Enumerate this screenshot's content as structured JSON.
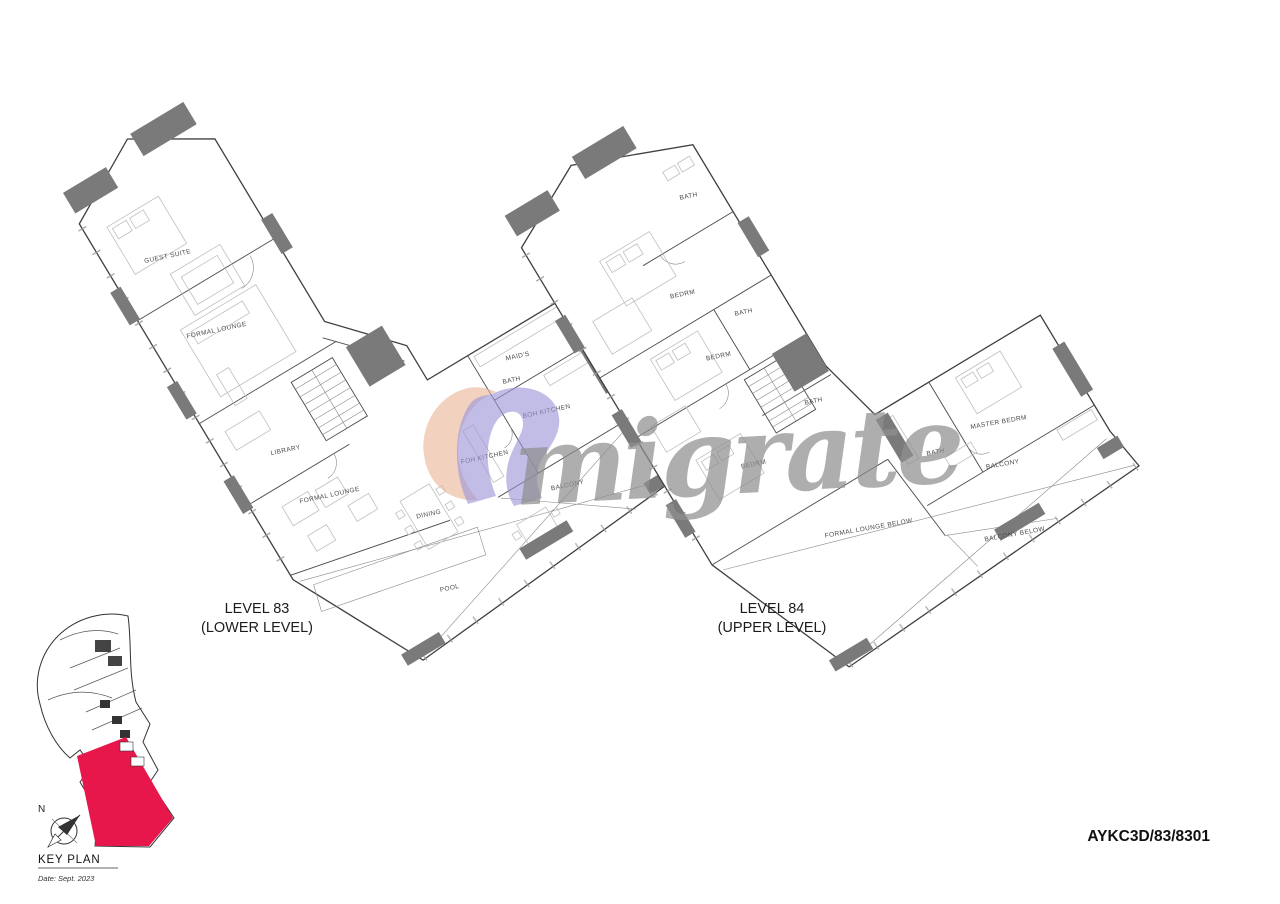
{
  "document": {
    "background": "#ffffff"
  },
  "plans": {
    "level83": {
      "title": "LEVEL 83",
      "subtitle": "(LOWER LEVEL)",
      "rooms": {
        "guest_suite": "GUEST SUITE",
        "formal_lounge_upper": "FORMAL LOUNGE",
        "library": "LIBRARY",
        "formal_lounge_lower": "FORMAL LOUNGE",
        "dining": "DINING",
        "pool": "POOL",
        "balcony": "BALCONY",
        "foh_kitchen": "FOH KITCHEN",
        "boh_kitchen": "BOH KITCHEN",
        "maids": "MAID'S",
        "bath": "BATH"
      }
    },
    "level84": {
      "title": "LEVEL 84",
      "subtitle": "(UPPER LEVEL)",
      "rooms": {
        "bath_top": "BATH",
        "bedroom_1": "BEDRM",
        "bath_mid": "BATH",
        "bedroom_2": "BEDRM",
        "bath_lower": "BATH",
        "bedroom_3": "BEDRM",
        "master_bedroom": "MASTER BEDRM",
        "master_bath": "BATH",
        "balcony": "BALCONY",
        "formal_lounge_below": "FORMAL LOUNGE BELOW",
        "balcony_below": "BALCONY BELOW"
      }
    }
  },
  "key_plan": {
    "title": "KEY PLAN",
    "date": "Date: Sept. 2023",
    "north_label": "N",
    "highlight_color": "#e8174b"
  },
  "title_block": {
    "drawing_number": "AYKC3D/83/8301"
  },
  "watermark": {
    "text": "migrate",
    "script_color": "#8f8f8f",
    "logo_peach": "#e9b295",
    "logo_purple": "#9b94d8"
  },
  "colors": {
    "plan_line": "#3f3f3f",
    "wall_fill": "#7a7a7a",
    "furniture": "#bfbfbf"
  }
}
